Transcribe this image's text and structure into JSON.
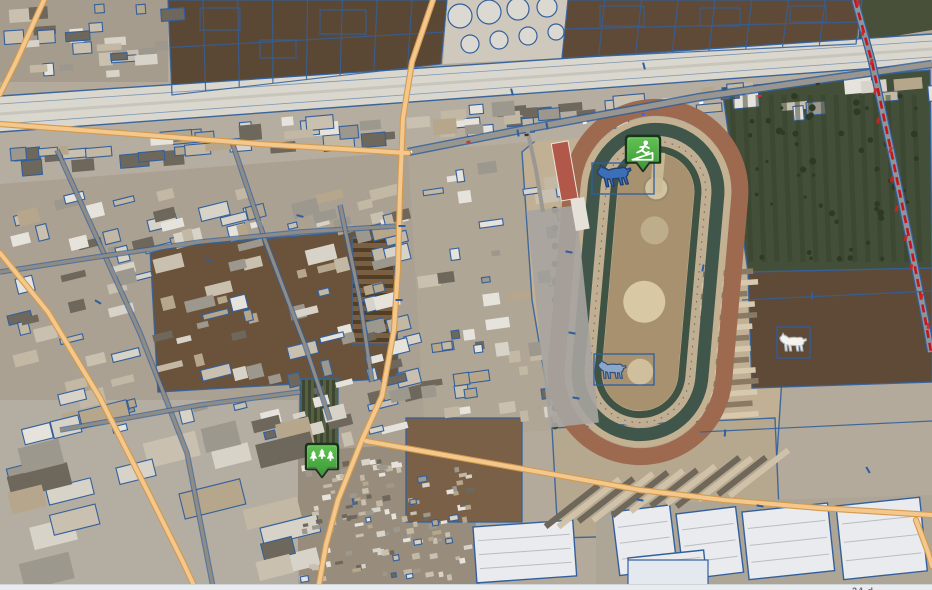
{
  "app": {
    "name": "gis-map-viewport",
    "bottom_bar": {
      "partial_text": "24 d"
    }
  },
  "palette": {
    "data_blue": "#33609c",
    "selection_blue": "#2e5e9e",
    "road_orange_fill": "#f4c88d",
    "road_orange_edge": "#d29a4e",
    "asphalt": "#98968f",
    "railway_red": "#c41818",
    "canal_light": "#dad7ce",
    "dirt_track": "#9d6a50",
    "track_gap_tan": "#c4b192",
    "hedge_green": "#41564a",
    "infield_tan": "#a8916f",
    "field_dark_brown": "#5a4734",
    "orchard_green": "#434f38",
    "pin_green_light": "#63c253",
    "pin_green_dark": "#379a34",
    "pin_outline": "#173617"
  },
  "markers": [
    {
      "id": "fitness-pin",
      "icon": "treadmill-runner-icon",
      "x": 643,
      "y": 155,
      "scale": 1.06
    },
    {
      "id": "park-pin",
      "icon": "conifer-trees-icon",
      "x": 322,
      "y": 462,
      "scale": 1.0
    }
  ],
  "horses": [
    {
      "id": "horse-marker-top",
      "x": 613,
      "y": 177,
      "w": 35,
      "fill": "#3d6fb8",
      "stroke": "#1f3f73",
      "rot": -8,
      "box": [
        592,
        163,
        62,
        31
      ]
    },
    {
      "id": "horse-marker-bottom",
      "x": 612,
      "y": 369,
      "w": 29,
      "fill": "#8ca6c8",
      "stroke": "#2f4f7c",
      "rot": 0,
      "box": [
        594,
        354,
        60,
        31
      ]
    },
    {
      "id": "horse-marker-white",
      "x": 793,
      "y": 342,
      "w": 28,
      "fill": "#f4f3ee",
      "stroke": "#aeb8c4",
      "rot": 0,
      "box": [
        777,
        327,
        33,
        31
      ]
    }
  ],
  "regions": [
    {
      "name": "top-left-blocks",
      "rect": [
        0,
        0,
        168,
        82
      ],
      "fill": "#a69c8e"
    },
    {
      "name": "field-a",
      "pts": [
        [
          168,
          0
        ],
        [
          447,
          0
        ],
        [
          441,
          64
        ],
        [
          172,
          95
        ]
      ],
      "fill": "#5a4734",
      "grid": true
    },
    {
      "name": "tank-farm-pad",
      "pts": [
        [
          447,
          0
        ],
        [
          568,
          0
        ],
        [
          562,
          58
        ],
        [
          443,
          64
        ]
      ],
      "fill": "#cfc9bd"
    },
    {
      "name": "field-b",
      "pts": [
        [
          568,
          0
        ],
        [
          862,
          0
        ],
        [
          856,
          44
        ],
        [
          562,
          58
        ]
      ],
      "fill": "#5f4a37",
      "grid": true
    },
    {
      "name": "green-corner",
      "pts": [
        [
          862,
          0
        ],
        [
          932,
          0
        ],
        [
          932,
          30
        ],
        [
          858,
          42
        ]
      ],
      "fill": "#49503a"
    },
    {
      "name": "left-industrial",
      "pts": [
        [
          0,
          132
        ],
        [
          410,
          152
        ],
        [
          430,
          430
        ],
        [
          300,
          590
        ],
        [
          0,
          590
        ]
      ],
      "fill": "#aaa193"
    },
    {
      "name": "mid-industrial",
      "pts": [
        [
          408,
          152
        ],
        [
          560,
          122
        ],
        [
          565,
          430
        ],
        [
          425,
          435
        ]
      ],
      "fill": "#b0a695"
    },
    {
      "name": "track-grounds",
      "pts": [
        [
          522,
          152
        ],
        [
          560,
          120
        ],
        [
          772,
          88
        ],
        [
          790,
          255
        ],
        [
          776,
          470
        ],
        [
          562,
          480
        ],
        [
          532,
          300
        ]
      ],
      "fill": "#c1b093",
      "outline": true
    },
    {
      "name": "canal-strip",
      "pts": [
        [
          0,
          96
        ],
        [
          932,
          34
        ],
        [
          932,
          64
        ],
        [
          0,
          132
        ]
      ],
      "fill": "#dad7ce"
    },
    {
      "name": "industrial-band",
      "pts": [
        [
          0,
          132
        ],
        [
          932,
          64
        ],
        [
          932,
          110
        ],
        [
          0,
          184
        ]
      ],
      "fill": "#b5ada0"
    },
    {
      "name": "central-field",
      "pts": [
        [
          150,
          248
        ],
        [
          395,
          228
        ],
        [
          398,
          378
        ],
        [
          158,
          392
        ]
      ],
      "fill": "#6b533b",
      "outline": true
    },
    {
      "name": "orchard",
      "pts": [
        [
          722,
          88
        ],
        [
          930,
          70
        ],
        [
          932,
          268
        ],
        [
          748,
          272
        ]
      ],
      "fill": "#434f38",
      "outline": true
    },
    {
      "name": "horse-field",
      "pts": [
        [
          748,
          272
        ],
        [
          932,
          268
        ],
        [
          932,
          382
        ],
        [
          752,
          388
        ]
      ],
      "fill": "#5e4a37",
      "outline": true
    },
    {
      "name": "stables-south-pad",
      "pts": [
        [
          552,
          428
        ],
        [
          775,
          418
        ],
        [
          780,
          532
        ],
        [
          558,
          538
        ]
      ],
      "fill": "#b6a88f",
      "outline": true
    },
    {
      "name": "greenhouse-pad",
      "pts": [
        [
          596,
          505
        ],
        [
          932,
          495
        ],
        [
          932,
          584
        ],
        [
          596,
          584
        ]
      ],
      "fill": "#ada595"
    },
    {
      "name": "residential",
      "pts": [
        [
          292,
          452
        ],
        [
          470,
          440
        ],
        [
          480,
          584
        ],
        [
          300,
          584
        ]
      ],
      "fill": "#988d7d"
    },
    {
      "name": "bottom-left-yards",
      "rect": [
        0,
        400,
        298,
        184
      ],
      "fill": "#b3ada2"
    },
    {
      "name": "plot-fields",
      "rect": [
        406,
        418,
        116,
        104
      ],
      "fill": "#7a6047",
      "outline": true,
      "grid": true
    },
    {
      "name": "row-crops-brown",
      "rect": [
        352,
        236,
        42,
        108
      ],
      "fill": "#7a5f42",
      "rows": "h",
      "outline": true
    },
    {
      "name": "row-crops-green",
      "rect": [
        300,
        378,
        38,
        74
      ],
      "fill": "#57603f",
      "rows": "v",
      "outline": true
    }
  ],
  "zones": [
    {
      "name": "z-topleft",
      "rect": [
        2,
        2,
        160,
        76
      ],
      "n": 26,
      "ang": -4,
      "min": [
        8,
        6
      ],
      "max": [
        26,
        14
      ],
      "blue": 0.5,
      "seed": 11
    },
    {
      "name": "z-band",
      "rect": [
        0,
        118,
        932,
        0
      ],
      "slope": -0.075,
      "base": 152,
      "jit": 14,
      "n": 72,
      "ang": -5,
      "min": [
        10,
        7
      ],
      "max": [
        32,
        16
      ],
      "blue": 0.55,
      "seed": 23
    },
    {
      "name": "z-left-ind",
      "rect": [
        4,
        188,
        412,
        250
      ],
      "n": 150,
      "ang": -14,
      "min": [
        8,
        5
      ],
      "max": [
        30,
        16
      ],
      "blue": 0.45,
      "seed": 37
    },
    {
      "name": "z-mid",
      "rect": [
        415,
        160,
        142,
        262
      ],
      "n": 46,
      "ang": -8,
      "min": [
        7,
        5
      ],
      "max": [
        24,
        14
      ],
      "blue": 0.5,
      "seed": 51
    },
    {
      "name": "z-warehouses",
      "rect": [
        4,
        408,
        290,
        168
      ],
      "n": 22,
      "ang": -14,
      "min": [
        26,
        16
      ],
      "max": [
        64,
        30
      ],
      "blue": 0.5,
      "seed": 67
    },
    {
      "name": "z-residential",
      "rect": [
        296,
        456,
        172,
        124
      ],
      "n": 130,
      "ang": -10,
      "min": [
        4,
        3
      ],
      "max": [
        9,
        6
      ],
      "blue": 0.08,
      "seed": 83
    }
  ],
  "greenhouses": [
    [
      612,
      512,
      58,
      64,
      -7
    ],
    [
      676,
      514,
      60,
      66,
      -7
    ],
    [
      742,
      512,
      86,
      68,
      -6
    ],
    [
      836,
      506,
      84,
      74,
      -6
    ],
    [
      628,
      558,
      76,
      28,
      -6
    ],
    [
      473,
      527,
      100,
      56,
      -4
    ]
  ],
  "tanks": [
    [
      460,
      16,
      12
    ],
    [
      489,
      12,
      12
    ],
    [
      518,
      9,
      11
    ],
    [
      547,
      7,
      10
    ],
    [
      470,
      44,
      9
    ],
    [
      499,
      40,
      9
    ],
    [
      528,
      36,
      9
    ],
    [
      556,
      32,
      8
    ]
  ],
  "roads": {
    "streets": [
      [
        [
          57,
          150
        ],
        [
          140,
          333
        ],
        [
          187,
          453
        ],
        [
          213,
          587
        ]
      ],
      [
        [
          232,
          142
        ],
        [
          265,
          240
        ],
        [
          305,
          345
        ],
        [
          330,
          420
        ]
      ],
      [
        [
          0,
          272
        ],
        [
          90,
          258
        ],
        [
          200,
          242
        ],
        [
          300,
          232
        ],
        [
          398,
          226
        ]
      ],
      [
        [
          60,
          430
        ],
        [
          200,
          405
        ],
        [
          300,
          392
        ]
      ],
      [
        [
          340,
          205
        ],
        [
          360,
          300
        ],
        [
          372,
          382
        ]
      ]
    ],
    "asphalt_main": [
      [
        408,
        152
      ],
      [
        520,
        130
      ],
      [
        700,
        97
      ],
      [
        932,
        64
      ]
    ],
    "track_access": [
      [
        527,
        128
      ],
      [
        536,
        170
      ],
      [
        543,
        212
      ]
    ],
    "orange": [
      [
        [
          433,
          0
        ],
        [
          412,
          62
        ],
        [
          403,
          118
        ],
        [
          400,
          190
        ],
        [
          398,
          268
        ],
        [
          394,
          330
        ],
        [
          382,
          396
        ],
        [
          362,
          440
        ],
        [
          338,
          500
        ],
        [
          326,
          545
        ],
        [
          318,
          590
        ]
      ],
      [
        [
          0,
          124
        ],
        [
          120,
          133
        ],
        [
          260,
          144
        ],
        [
          408,
          153
        ]
      ],
      [
        [
          0,
          253
        ],
        [
          48,
          312
        ],
        [
          100,
          398
        ],
        [
          148,
          492
        ],
        [
          182,
          560
        ],
        [
          196,
          590
        ]
      ],
      [
        [
          44,
          0
        ],
        [
          16,
          62
        ],
        [
          0,
          94
        ]
      ],
      [
        [
          366,
          441
        ],
        [
          450,
          456
        ],
        [
          540,
          472
        ],
        [
          640,
          490
        ],
        [
          724,
          500
        ],
        [
          820,
          508
        ],
        [
          932,
          515
        ]
      ],
      [
        [
          916,
          520
        ],
        [
          928,
          552
        ],
        [
          932,
          566
        ]
      ]
    ],
    "railway": [
      [
        855,
        0
      ],
      [
        872,
        62
      ],
      [
        893,
        160
      ],
      [
        912,
        252
      ],
      [
        925,
        318
      ],
      [
        931,
        352
      ]
    ]
  },
  "racetrack": {
    "cx": 648,
    "cy": 282,
    "rot": 5,
    "straight": 350,
    "width": 168,
    "rings": [
      {
        "w": 168,
        "h": 350,
        "color": "#9d6a50",
        "sw": 17
      },
      {
        "w": 140,
        "h": 322,
        "color": "#c4b192",
        "sw": 9
      },
      {
        "w": 124,
        "h": 306,
        "color": "#41564a",
        "sw": 13
      },
      {
        "w": 100,
        "h": 282,
        "color": "#bfae92",
        "sw": 8
      },
      {
        "w": 84,
        "h": 266,
        "color": "#3f5345",
        "sw": 7
      }
    ],
    "infield_fill": "#a8916f"
  },
  "ticks": [
    [
      518,
      133,
      80
    ],
    [
      547,
      126,
      80
    ],
    [
      569,
      252,
      10
    ],
    [
      572,
      333,
      10
    ],
    [
      576,
      398,
      10
    ],
    [
      703,
      268,
      100
    ],
    [
      725,
      433,
      95
    ],
    [
      812,
      296,
      90
    ],
    [
      868,
      470,
      60
    ],
    [
      644,
      66,
      75
    ],
    [
      512,
      92,
      75
    ],
    [
      208,
      260,
      20
    ],
    [
      300,
      216,
      15
    ],
    [
      98,
      302,
      30
    ],
    [
      402,
      226,
      0
    ],
    [
      399,
      300,
      0
    ],
    [
      640,
      500,
      10
    ],
    [
      760,
      506,
      10
    ]
  ],
  "field_lines": [
    [
      [
        742,
        300
      ],
      [
        932,
        291
      ]
    ],
    [
      [
        700,
        432
      ],
      [
        932,
        421
      ]
    ]
  ]
}
